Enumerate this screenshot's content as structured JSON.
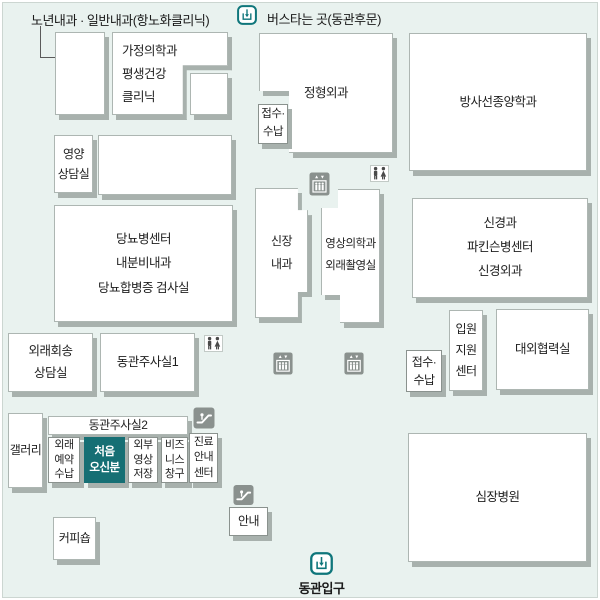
{
  "colors": {
    "background": "#e9f2ef",
    "box_fill": "#ffffff",
    "shadow": "#a8b1ad",
    "accent_teal": "#0f767b",
    "highlight_teal": "#166f74",
    "icon_gray": "#8a918e",
    "text": "#1e1e1e"
  },
  "labels": {
    "annotation": "노년내과 · 일반내과(항노화클리닉)",
    "bus_stop": "버스타는 곳(동관후문)",
    "entrance": "동관입구"
  },
  "rooms": [
    {
      "id": "senior-internal-medicine",
      "lines": [],
      "x": 55,
      "y": 32,
      "w": 50,
      "h": 83
    },
    {
      "id": "family-medicine",
      "lines": [
        "가정의학과",
        "평생건강",
        "클리닉"
      ],
      "x": 112,
      "y": 32,
      "w": 116,
      "h": 83,
      "clip": "0% 0%,100% 0%,100% 40%,61% 40%,61% 100%,0% 100%",
      "align": "left",
      "lh": "1.85"
    },
    {
      "id": "unnamed-room-small",
      "lines": [],
      "x": 190,
      "y": 73,
      "w": 38,
      "h": 42
    },
    {
      "id": "nutrition-counseling",
      "lines": [
        "영양",
        "상담실"
      ],
      "x": 54,
      "y": 135,
      "w": 39,
      "h": 58,
      "lh": "1.7",
      "font": "12"
    },
    {
      "id": "unnamed-room-wide",
      "lines": [],
      "x": 98,
      "y": 135,
      "w": 134,
      "h": 60
    },
    {
      "id": "diabetes-center",
      "lines": [
        "당뇨병센터",
        "내분비내과",
        "당뇨합병증 검사실"
      ],
      "x": 54,
      "y": 205,
      "w": 179,
      "h": 117,
      "lh": "1.95"
    },
    {
      "id": "orthopedics",
      "lines": [
        "정형외과"
      ],
      "x": 259,
      "y": 33,
      "w": 134,
      "h": 120,
      "clip": "0% 0%,100% 0%,100% 100%,22.4% 100%,22.4% 48.3%,0% 48.3%"
    },
    {
      "id": "reception-payment-1",
      "lines": [
        "접수·",
        "수납"
      ],
      "x": 258,
      "y": 104,
      "w": 30,
      "h": 40,
      "cls": "room--bordered",
      "font": "11.5",
      "lh": "1.55"
    },
    {
      "id": "radiation-oncology",
      "lines": [
        "방사선종양학과"
      ],
      "x": 409,
      "y": 33,
      "w": 178,
      "h": 138
    },
    {
      "id": "nephrology",
      "lines": [
        "신장",
        "내과"
      ],
      "x": 255,
      "y": 188,
      "w": 53,
      "h": 130,
      "clip": "0% 0%,81% 0%,81% 17%,100% 17%,100% 80%,81% 80%,81% 100%,0% 100%",
      "lh": "1.9",
      "font": "12"
    },
    {
      "id": "radiology-outpatient-imaging",
      "lines": [
        "영상의학과",
        "외래촬영실"
      ],
      "x": 321,
      "y": 189,
      "w": 59,
      "h": 134,
      "clip": "0% 14.2%,28.8% 14.2%,28.8% 0%,100% 0%,100% 100%,32.2% 100%,32.2% 79.1%,0% 79.1%",
      "lh": "1.9",
      "font": "11.5"
    },
    {
      "id": "neurology-parkinson-neurosurgery",
      "lines": [
        "신경과",
        "파킨슨병센터",
        "신경외과"
      ],
      "x": 412,
      "y": 198,
      "w": 176,
      "h": 100,
      "lh": "1.9"
    },
    {
      "id": "reception-payment-2",
      "lines": [
        "접수·",
        "수납"
      ],
      "x": 406,
      "y": 350,
      "w": 36,
      "h": 42,
      "cls": "room--bordered",
      "font": "12",
      "lh": "1.5"
    },
    {
      "id": "admission-support-center",
      "lines": [
        "입원",
        "지원",
        "센터"
      ],
      "x": 449,
      "y": 310,
      "w": 34,
      "h": 81,
      "lh": "1.75",
      "font": "12"
    },
    {
      "id": "external-cooperation-office",
      "lines": [
        "대외협력실"
      ],
      "x": 496,
      "y": 309,
      "w": 93,
      "h": 81
    },
    {
      "id": "outpatient-return-counseling",
      "lines": [
        "외래회송",
        "상담실"
      ],
      "x": 8,
      "y": 333,
      "w": 85,
      "h": 59,
      "lh": "1.7"
    },
    {
      "id": "injection-room-1",
      "lines": [
        "동관주사실1"
      ],
      "x": 100,
      "y": 333,
      "w": 95,
      "h": 59
    },
    {
      "id": "gallery",
      "lines": [
        "갤러리"
      ],
      "x": 8,
      "y": 413,
      "w": 35,
      "h": 75,
      "font": "12"
    },
    {
      "id": "injection-room-2",
      "lines": [
        "동관주사실2"
      ],
      "x": 48,
      "y": 416,
      "w": 140,
      "h": 19,
      "font": "12",
      "lh": "1.2"
    },
    {
      "id": "outpatient-reservation-payment",
      "lines": [
        "외래",
        "예약",
        "수납"
      ],
      "x": 48,
      "y": 437,
      "w": 32,
      "h": 46,
      "cls": "room--bordered",
      "font": "11",
      "lh": "1.35"
    },
    {
      "id": "first-time-visitors",
      "lines": [
        "처음",
        "오신분"
      ],
      "x": 84,
      "y": 437,
      "w": 41,
      "h": 46,
      "cls": "room--teal",
      "font": "11.5",
      "lh": "1.4"
    },
    {
      "id": "external-imaging-storage",
      "lines": [
        "외부",
        "영상",
        "저장"
      ],
      "x": 128,
      "y": 437,
      "w": 30,
      "h": 46,
      "cls": "room--bordered",
      "font": "11",
      "lh": "1.35"
    },
    {
      "id": "business-counter",
      "lines": [
        "비즈",
        "니스",
        "창구"
      ],
      "x": 161,
      "y": 437,
      "w": 27,
      "h": 46,
      "cls": "room--bordered",
      "font": "11",
      "lh": "1.35"
    },
    {
      "id": "treatment-info-center",
      "lines": [
        "진료",
        "안내",
        "센터"
      ],
      "x": 189,
      "y": 433,
      "w": 29,
      "h": 50,
      "cls": "room--bordered",
      "font": "11",
      "lh": "1.4"
    },
    {
      "id": "information-desk",
      "lines": [
        "안내"
      ],
      "x": 229,
      "y": 507,
      "w": 39,
      "h": 29,
      "cls": "room--bordered",
      "font": "12",
      "lh": "1.3"
    },
    {
      "id": "coffee-shop",
      "lines": [
        "커피숍"
      ],
      "x": 53,
      "y": 517,
      "w": 43,
      "h": 43,
      "font": "12"
    },
    {
      "id": "heart-hospital",
      "lines": [
        "심장병원"
      ],
      "x": 408,
      "y": 433,
      "w": 179,
      "h": 129
    }
  ],
  "icons": [
    {
      "type": "entrance",
      "x": 237,
      "y": 5,
      "w": 20,
      "h": 20
    },
    {
      "type": "elevator",
      "x": 309,
      "y": 172,
      "w": 21,
      "h": 24
    },
    {
      "type": "restroom",
      "x": 370,
      "y": 165,
      "w": 19,
      "h": 17
    },
    {
      "type": "elevator",
      "x": 272,
      "y": 352,
      "w": 22,
      "h": 23
    },
    {
      "type": "elevator",
      "x": 343,
      "y": 352,
      "w": 22,
      "h": 23
    },
    {
      "type": "restroom",
      "x": 204,
      "y": 335,
      "w": 19,
      "h": 17
    },
    {
      "type": "escalator",
      "x": 193,
      "y": 407,
      "w": 22,
      "h": 22
    },
    {
      "type": "escalator",
      "x": 233,
      "y": 484,
      "w": 21,
      "h": 22
    },
    {
      "type": "entrance",
      "x": 310,
      "y": 552,
      "w": 23,
      "h": 23
    }
  ]
}
